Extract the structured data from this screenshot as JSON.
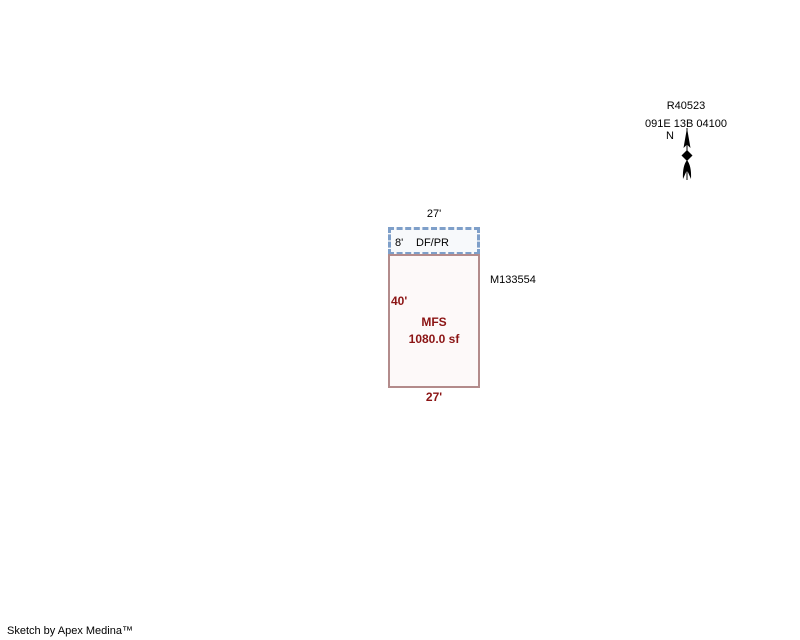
{
  "canvas": {
    "background": "#ffffff",
    "width": 800,
    "height": 640
  },
  "parcel_header": {
    "account_id": "R40523",
    "map_taxlot": "091E 13B 04100",
    "compass": {
      "label": "N",
      "icon": "north-arrow"
    }
  },
  "sketch": {
    "porch": {
      "width_label": "27'",
      "depth_label": "8'",
      "area_code": "DF/PR",
      "border_color": "#7e9fc9",
      "fill_color": "#f7f9fb"
    },
    "building": {
      "height_label": "40'",
      "width_label": "27'",
      "area_code": "MFS",
      "area_value": "1080.0 sf",
      "border_color": "#b38b8b",
      "fill_color": "#fdf9f9",
      "label_color": "#8b1414"
    },
    "reference_marker": "M133554"
  },
  "footer": {
    "credit": "Sketch by Apex Medina™"
  }
}
